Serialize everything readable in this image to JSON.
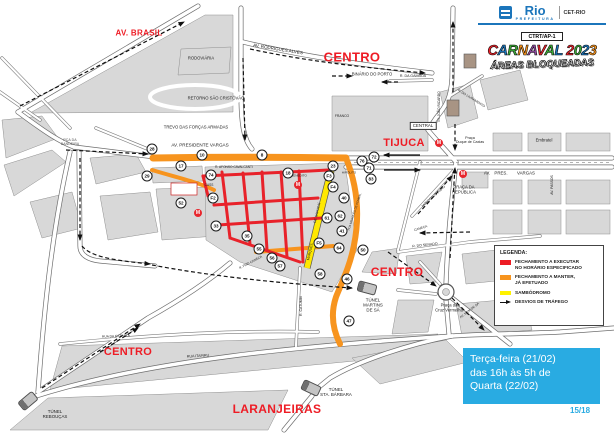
{
  "colors": {
    "red": "#ed1c24",
    "orange": "#f7941e",
    "yellow": "#ffe800",
    "blue": "#29abe2",
    "area_label": "#ee1c25"
  },
  "header": {
    "logo_text": "Rio",
    "logo_sub": "PREFEITURA",
    "org": "CET-RIO",
    "unit": "CTRT/AP-1",
    "title": "CARNAVAL 2023",
    "title_colors": [
      "#e8222a",
      "#1b75bb",
      "#3aa935",
      "#f7941e",
      "#8e4a9e",
      "#e8222a",
      "#3aa935",
      "#1b75bb",
      null,
      "#e8222a",
      "#3aa935",
      "#1b75bb",
      "#f7941e"
    ],
    "subtitle": "ÁREAS BLOQUEADAS"
  },
  "legend": {
    "title": "LEGENDA:",
    "items": [
      {
        "type": "swatch",
        "color": "#ed1c24",
        "label": "FECHAMENTO A EXECUTAR\nNO HORÁRIO ESPECIFICADO"
      },
      {
        "type": "swatch",
        "color": "#f7941e",
        "label": "FECHAMENTO A MANTER,\nJÁ EFETUADO"
      },
      {
        "type": "swatch",
        "color": "#fff200",
        "label": "SAMBÓDROMO"
      },
      {
        "type": "arrow",
        "color": "#000000",
        "label": "DESVIOS DE TRÁFEGO"
      }
    ]
  },
  "schedule": {
    "text": "Terça-feira (21/02)\ndas 16h às 5h de\nQuarta (22/02)",
    "page": "15/18"
  },
  "map": {
    "area_labels": [
      {
        "t": "AV. BRASIL",
        "x": 139,
        "y": 33,
        "s": 8
      },
      {
        "t": "CENTRO",
        "x": 352,
        "y": 57,
        "s": 13
      },
      {
        "t": "TIJUCA",
        "x": 404,
        "y": 143,
        "s": 11
      },
      {
        "t": "CENTRO",
        "x": 397,
        "y": 272,
        "s": 12
      },
      {
        "t": "CENTRO",
        "x": 128,
        "y": 352,
        "s": 11
      },
      {
        "t": "LARANJEIRAS",
        "x": 277,
        "y": 409,
        "s": 12
      }
    ],
    "street_labels": [
      {
        "t": "AV. RODRIGUES ALVES",
        "x": 278,
        "y": 49,
        "s": 4.5,
        "r": 9
      },
      {
        "t": "BINÁRIO DO PORTO",
        "x": 372,
        "y": 75,
        "s": 4.2
      },
      {
        "t": "RODOVIÁRIA",
        "x": 201,
        "y": 59,
        "s": 4.2
      },
      {
        "t": "RETORNO SÃO CRISTÓVÃO",
        "x": 216,
        "y": 99,
        "s": 4.2
      },
      {
        "t": "TREVO DAS FORÇAS ARMADAS",
        "x": 196,
        "y": 128,
        "s": 4.2
      },
      {
        "t": "AV. PRESIDENTE VARGAS",
        "x": 200,
        "y": 145,
        "s": 4.6
      },
      {
        "t": "PÇA DA\nBANDEIRA",
        "x": 70,
        "y": 142,
        "s": 3.6,
        "c": "#555"
      },
      {
        "t": "R. DA GAMBOA",
        "x": 413,
        "y": 76,
        "s": 3.6
      },
      {
        "t": "TN. JOÃO RICARDO",
        "x": 440,
        "y": 107,
        "s": 3.3,
        "r": -90
      },
      {
        "t": "R. DO LIVRAMENTO",
        "x": 471,
        "y": 99,
        "s": 3.3,
        "r": 32
      },
      {
        "t": "CENTRAL",
        "x": 423,
        "y": 126,
        "s": 4.4,
        "box": true
      },
      {
        "t": "Praça\nDuque de Caxias",
        "x": 470,
        "y": 140,
        "s": 3.7
      },
      {
        "t": "Embratel",
        "x": 544,
        "y": 141,
        "s": 4.2
      },
      {
        "t": "AV.",
        "x": 487,
        "y": 174,
        "s": 4.4
      },
      {
        "t": "PRES.",
        "x": 501,
        "y": 174,
        "s": 4.4
      },
      {
        "t": "VARGAS",
        "x": 526,
        "y": 174,
        "s": 4.4
      },
      {
        "t": "AV. PASSOS",
        "x": 553,
        "y": 185,
        "s": 3.4,
        "r": -90
      },
      {
        "t": "PRAÇA DA\nREPÚBLICA",
        "x": 464,
        "y": 190,
        "s": 4.2
      },
      {
        "t": "R. AFONSO CAVALCANTI",
        "x": 234,
        "y": 168,
        "s": 3.2
      },
      {
        "t": "R. BENEDITO",
        "x": 297,
        "y": 176,
        "s": 3.1
      },
      {
        "t": "HIPÓLITO",
        "x": 349,
        "y": 173,
        "s": 3.1
      },
      {
        "t": "DE SAPUCAÍ",
        "x": 318,
        "y": 213,
        "s": 3.4,
        "r": -77
      },
      {
        "t": "MARQUÊS",
        "x": 311,
        "y": 252,
        "s": 3.4,
        "r": -77
      },
      {
        "t": "RUA MARQUÊS DE POMBAL",
        "x": 355,
        "y": 212,
        "s": 2.9,
        "r": -72
      },
      {
        "t": "MONCORVO FILHO",
        "x": 434,
        "y": 197,
        "s": 3.3,
        "r": -42
      },
      {
        "t": "CANECA",
        "x": 421,
        "y": 229,
        "s": 3.3,
        "r": -18
      },
      {
        "t": "R. FREI CANECA",
        "x": 251,
        "y": 263,
        "s": 3.2,
        "r": -28
      },
      {
        "t": "R. DO SENADO",
        "x": 425,
        "y": 246,
        "s": 3.5,
        "r": -6
      },
      {
        "t": "R. CATUMBI",
        "x": 302,
        "y": 306,
        "s": 3.5,
        "r": -90
      },
      {
        "t": "RUA ITAPIRU",
        "x": 198,
        "y": 356,
        "s": 3.6,
        "r": -3
      },
      {
        "t": "RUA DA ESTRELA",
        "x": 116,
        "y": 337,
        "s": 3.3,
        "r": -2
      },
      {
        "t": "TÚNEL\nMARTINS\nDE SÁ",
        "x": 373,
        "y": 306,
        "s": 4.4
      },
      {
        "t": "Praça da\nCruz Vermelha",
        "x": 449,
        "y": 308,
        "s": 4.2
      },
      {
        "t": "TÚNEL\nSTA. BÁRBARA",
        "x": 336,
        "y": 393,
        "s": 4.4
      },
      {
        "t": "TÚNEL\nREBOUÇAS",
        "x": 55,
        "y": 415,
        "s": 4.4
      },
      {
        "t": "AV. MEM DE SÁ",
        "x": 470,
        "y": 311,
        "s": 3.2,
        "r": -38
      },
      {
        "t": "FRANCO",
        "x": 342,
        "y": 117,
        "s": 3.4
      },
      {
        "t": "CASS",
        "x": 209,
        "y": 186,
        "s": 3.2
      }
    ],
    "markers": [
      {
        "n": "28",
        "x": 152,
        "y": 149
      },
      {
        "n": "29",
        "x": 147,
        "y": 176
      },
      {
        "n": "17",
        "x": 181,
        "y": 166
      },
      {
        "n": "10",
        "x": 202,
        "y": 155
      },
      {
        "n": "8",
        "x": 262,
        "y": 155
      },
      {
        "n": "74",
        "x": 211,
        "y": 175
      },
      {
        "n": "18",
        "x": 288,
        "y": 173
      },
      {
        "n": "F2",
        "x": 213,
        "y": 198
      },
      {
        "n": "52",
        "x": 181,
        "y": 203
      },
      {
        "n": "33",
        "x": 216,
        "y": 226
      },
      {
        "n": "35",
        "x": 247,
        "y": 236
      },
      {
        "n": "55",
        "x": 259,
        "y": 249
      },
      {
        "n": "56",
        "x": 272,
        "y": 258
      },
      {
        "n": "57",
        "x": 280,
        "y": 266
      },
      {
        "n": "58",
        "x": 320,
        "y": 274
      },
      {
        "n": "F3",
        "x": 329,
        "y": 176
      },
      {
        "n": "F4",
        "x": 333,
        "y": 187
      },
      {
        "n": "40",
        "x": 344,
        "y": 198
      },
      {
        "n": "61",
        "x": 327,
        "y": 218
      },
      {
        "n": "62",
        "x": 340,
        "y": 216
      },
      {
        "n": "41",
        "x": 342,
        "y": 231
      },
      {
        "n": "F5",
        "x": 319,
        "y": 243
      },
      {
        "n": "64",
        "x": 339,
        "y": 248
      },
      {
        "n": "50",
        "x": 363,
        "y": 250
      },
      {
        "n": "46",
        "x": 347,
        "y": 279
      },
      {
        "n": "47",
        "x": 349,
        "y": 321
      },
      {
        "n": "76",
        "x": 362,
        "y": 161
      },
      {
        "n": "72",
        "x": 374,
        "y": 157
      },
      {
        "n": "71",
        "x": 369,
        "y": 168
      },
      {
        "n": "83",
        "x": 371,
        "y": 179
      },
      {
        "n": "23",
        "x": 333,
        "y": 166
      }
    ],
    "metro_stations": [
      {
        "x": 439,
        "y": 143
      },
      {
        "x": 463,
        "y": 174
      },
      {
        "x": 198,
        "y": 213
      },
      {
        "x": 298,
        "y": 185
      }
    ],
    "tunnels": [
      {
        "x": 28,
        "y": 401,
        "r": -40
      },
      {
        "x": 367,
        "y": 288,
        "r": 15
      },
      {
        "x": 311,
        "y": 388,
        "r": 25
      }
    ]
  }
}
